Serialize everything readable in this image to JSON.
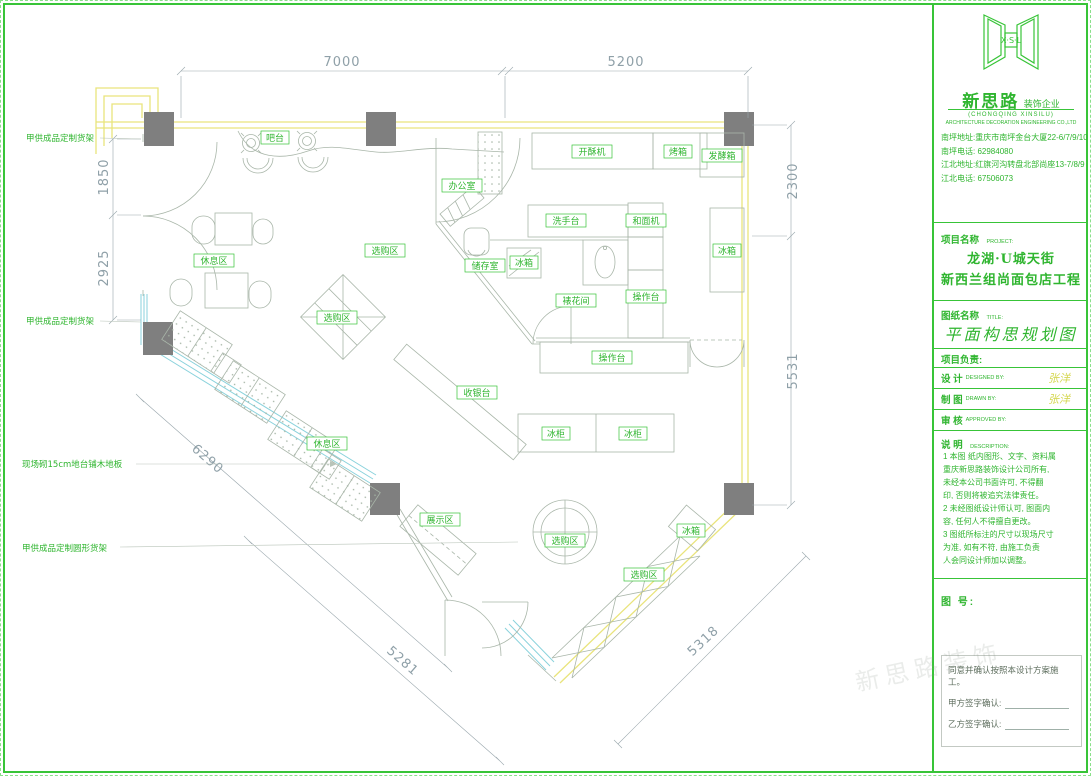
{
  "watermark": "新思路装饰",
  "plan": {
    "dims": {
      "d7000": "7000",
      "d5200": "5200",
      "d1850": "1850",
      "d2925": "2925",
      "d2300": "2300",
      "d5531": "5531",
      "d6290": "6290",
      "d5281": "5281",
      "d5318": "5318"
    },
    "annotations": {
      "shelf_top": "甲供成品定制货架",
      "shelf_mid": "甲供成品定制货架",
      "platform": "现场砌15cm地台铺木地板",
      "round_shelf": "甲供成品定制圆形货架"
    },
    "labels": {
      "bar": "吧台",
      "office": "办公室",
      "storage": "储存室",
      "browse1": "选购区",
      "browse2": "选购区",
      "browse3": "选购区",
      "browse4": "选购区",
      "rest1": "休息区",
      "rest2": "休息区",
      "display": "展示区",
      "cashier": "收银台",
      "freezer1": "冰柜",
      "freezer2": "冰柜",
      "fridge_kitchen": "冰箱",
      "fridge_cold": "冰箱",
      "fridge_corner": "冰箱",
      "sheeter": "开酥机",
      "oven": "烤箱",
      "proofer": "发酵箱",
      "washstand": "洗手台",
      "mixer": "和面机",
      "piping": "裱花间",
      "worktop_v": "操作台",
      "worktop_h": "操作台"
    }
  },
  "title_block": {
    "logo_letters": "X·S·L",
    "brand": "新思路",
    "brand_suffix": "装饰企业",
    "brand_en1": "(CHONGQING XINSILU)",
    "brand_en2": "ARCHITECTURE DECORATION ENGINEERING CO.,LTD",
    "contact_lines": [
      "南坪地址:重庆市南坪金台大厦22-6/7/9/10",
      "南坪电话: 62984080",
      "江北地址:红旗河沟转盘北部尚座13-7/8/9",
      "江北电话: 67506073"
    ],
    "project_label": "项目名称",
    "project_label_en": "PROJECT:",
    "project_line1": "龙湖·U城天街",
    "project_line2": "新西兰组尚面包店工程",
    "sheet_label": "图纸名称",
    "sheet_label_en": "TITLE:",
    "sheet_title": "平面构思规划图",
    "lead_label": "项目负责:",
    "design_label": "设 计",
    "design_en": "DESIGNED BY:",
    "design_value": "张洋",
    "draft_label": "制 图",
    "draft_en": "DRAWN BY:",
    "draft_value": "张洋",
    "review_label": "审 核",
    "review_en": "APPROVED BY:",
    "review_value": "",
    "desc_label": "说 明",
    "desc_en": "DESCRIPTION:",
    "notes": [
      "1 本图 纸内图形、文字、资料属",
      "  重庆新思路装饰设计公司所有,",
      "  未经本公司书面许可, 不得翻",
      "  印, 否则将被追究法律责任。",
      "2 未经图纸设计师认可, 图面内",
      "  容, 任何人不得擅自更改。",
      "3 图纸所标注的尺寸以现场尺寸",
      "  为准, 如有不符, 由施工负责",
      "  人会同设计师加以调整。"
    ],
    "sheet_no_label": "图 号:",
    "confirm_line": "同意并确认按照本设计方案施工。",
    "party_a": "甲方签字确认:",
    "party_b": "乙方签字确认:"
  }
}
